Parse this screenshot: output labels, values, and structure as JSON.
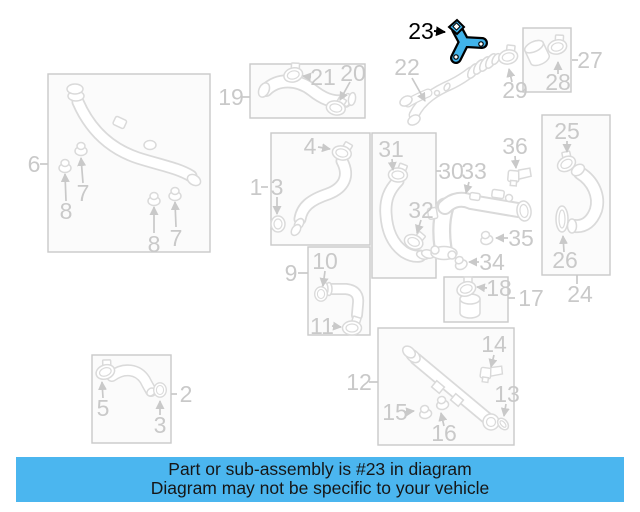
{
  "diagram": {
    "callouts": {
      "c1": "1",
      "c2": "2",
      "c3a": "3",
      "c3b": "3",
      "c4": "4",
      "c5": "5",
      "c6": "6",
      "c7a": "7",
      "c7b": "7",
      "c8a": "8",
      "c8b": "8",
      "c9": "9",
      "c10": "10",
      "c11": "11",
      "c12": "12",
      "c13": "13",
      "c14": "14",
      "c15": "15",
      "c16": "16",
      "c17": "17",
      "c18": "18",
      "c19": "19",
      "c20": "20",
      "c21": "21",
      "c22": "22",
      "c23": "23",
      "c24": "24",
      "c25": "25",
      "c26": "26",
      "c27": "27",
      "c28": "28",
      "c29": "29",
      "c30": "30",
      "c31": "31",
      "c32": "32",
      "c33": "33",
      "c34": "34",
      "c35": "35",
      "c36": "36"
    },
    "highlighted_part": "23"
  },
  "colors": {
    "line_art": "#dadada",
    "label_gray": "#c9c9c9",
    "box_fill": "#fbfbfb",
    "box_border": "#c9c9c9",
    "highlight_blue": "#41b3ea",
    "banner_blue": "#4bb6ef",
    "label_black": "#000000"
  },
  "banner": {
    "line1": "Part or sub-assembly is #23 in diagram",
    "line2": "Diagram may not be specific to your vehicle"
  }
}
